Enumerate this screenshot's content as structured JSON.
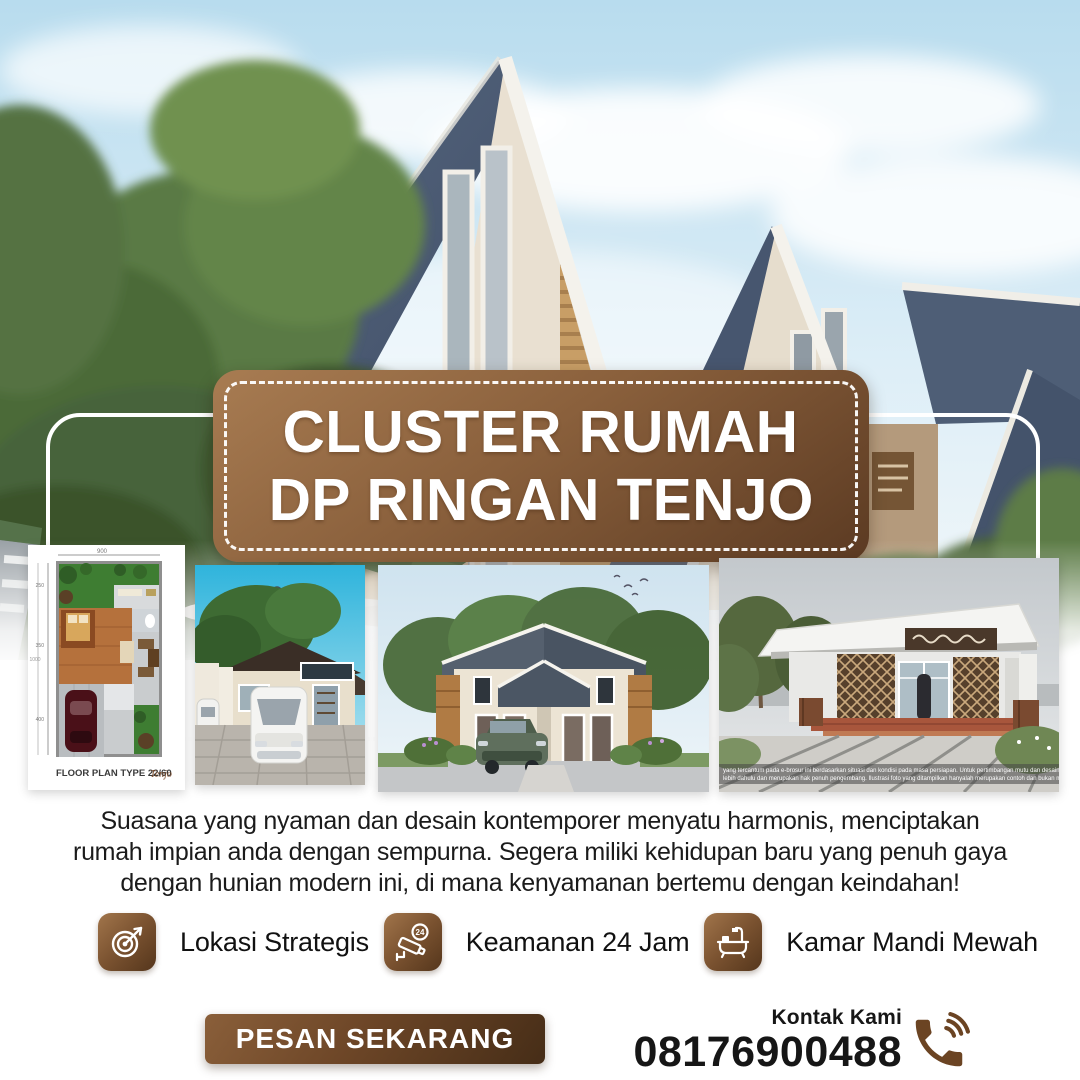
{
  "title": {
    "line1": "CLUSTER RUMAH",
    "line2": "DP RINGAN TENJO"
  },
  "gallery": {
    "floor_plan": {
      "caption": "FLOOR PLAN  TYPE 22/60",
      "logo": "Tenjo",
      "dims": {
        "top": "900",
        "left_total": "1000",
        "left_segments": [
          "250",
          "350",
          "400"
        ]
      }
    },
    "disclaimer": {
      "line1": "yang tercantum pada e-brosur ini berdasarkan situasi dan kondisi pada masa persiapan. Untuk pertimbangan mutu dan desain dapat berubah",
      "line2": "lebih dahulu dan merupakan hak penuh pengembang. Ilustrasi foto yang ditampilkan hanyalah merupakan contoh dan bukan merupakan"
    }
  },
  "description": {
    "line1": "Suasana yang nyaman dan desain kontemporer menyatu harmonis, menciptakan",
    "line2": "rumah impian anda dengan sempurna. Segera miliki kehidupan baru yang penuh gaya",
    "line3": "dengan hunian modern ini, di mana kenyamanan bertemu dengan keindahan!"
  },
  "features": [
    {
      "icon": "target-icon",
      "label": "Lokasi Strategis"
    },
    {
      "icon": "cctv-icon",
      "label": "Keamanan 24 Jam",
      "badge": "24"
    },
    {
      "icon": "bathtub-icon",
      "label": "Kamar Mandi Mewah"
    }
  ],
  "cta": {
    "label": "PESAN SEKARANG"
  },
  "contact": {
    "label": "Kontak Kami",
    "phone": "08176900488"
  },
  "colors": {
    "accent_brown": "#6b4423",
    "plaque_light": "#a87c52",
    "plaque_dark": "#5b3a22",
    "cta_dark": "#462d17",
    "text_dark": "#1b1b1b"
  }
}
